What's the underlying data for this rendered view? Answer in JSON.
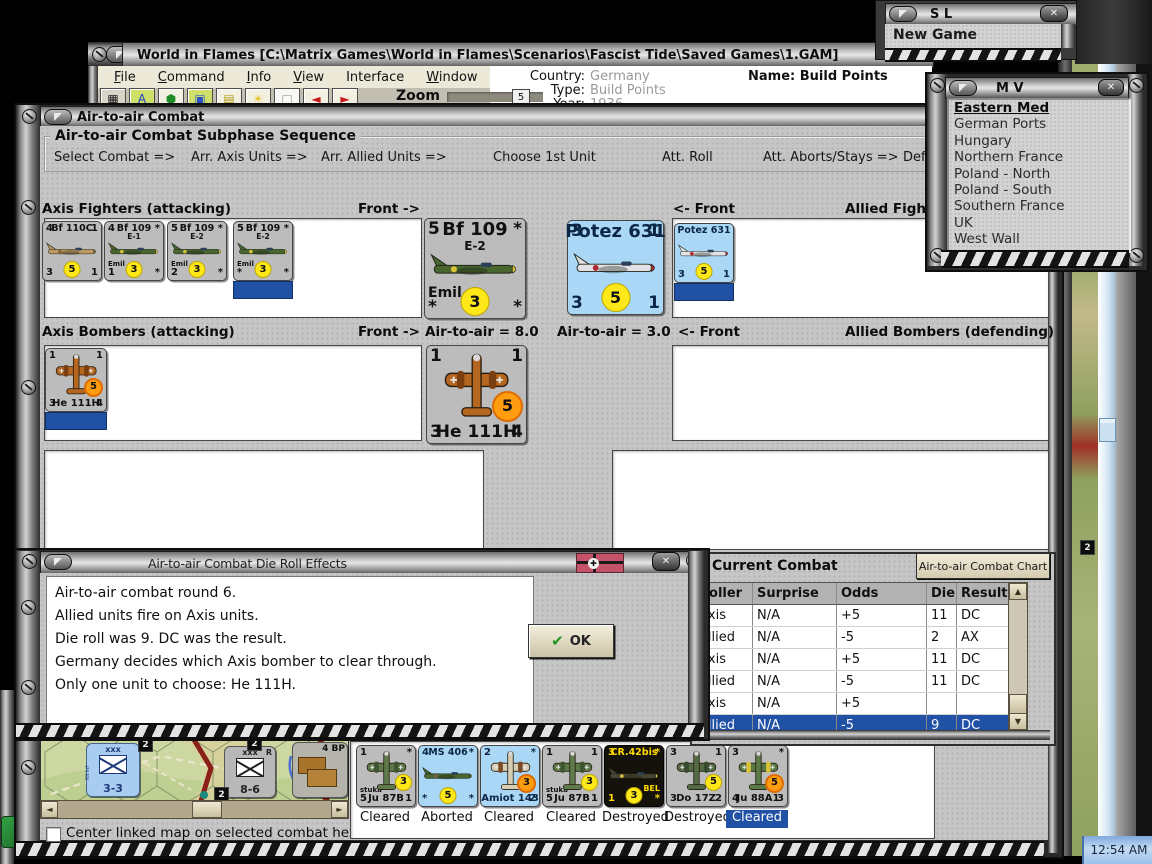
{
  "desktop": {
    "clock": "12:54 AM"
  },
  "main_window": {
    "title": "World in Flames [C:\\Matrix Games\\World in Flames\\Scenarios\\Fascist Tide\\Saved Games\\1.GAM]",
    "menu_items": [
      {
        "label": "File",
        "accel": true
      },
      {
        "label": "Command",
        "accel": true
      },
      {
        "label": "Info",
        "accel": true
      },
      {
        "label": "View",
        "accel": true
      },
      {
        "label": "Interface",
        "accel": false
      },
      {
        "label": "Window",
        "accel": true
      },
      {
        "label": "Debug",
        "accel": false
      },
      {
        "label": "Help",
        "accel": true
      }
    ],
    "toolbar": {
      "zoom_label": "Zoom",
      "zoom_value": "5",
      "icons": [
        {
          "name": "train-icon",
          "glyph": "▦",
          "color": "#161616",
          "bg": "#d8d4c8"
        },
        {
          "name": "letter-a-icon",
          "glyph": "A",
          "color": "#1a3ac8",
          "bg": "#cfe06a"
        },
        {
          "name": "shield-icon",
          "glyph": "⬢",
          "color": "#1d8a24",
          "bg": "#f2f0e0"
        },
        {
          "name": "map-window-icon",
          "glyph": "▣",
          "color": "#2a50c8",
          "bg": "#cfe06a"
        },
        {
          "name": "notes-icon",
          "glyph": "▤",
          "color": "#b09a10",
          "bg": "#f2f0e0"
        },
        {
          "name": "sun-icon",
          "glyph": "☀",
          "color": "#e8c020",
          "bg": "#f2f0e0"
        },
        {
          "name": "blank-icon",
          "glyph": "□",
          "color": "#999999",
          "bg": "#f8f8f4"
        },
        {
          "name": "arrow-left-icon",
          "glyph": "◄",
          "color": "#c81a1a",
          "bg": "#f2f0e0"
        },
        {
          "name": "arrow-right-icon",
          "glyph": "►",
          "color": "#c81a1a",
          "bg": "#f2f0e0"
        }
      ]
    },
    "info": {
      "country_label": "Country:",
      "country_value": "Germany",
      "type_label": "Type:",
      "type_value": "Build Points",
      "year_label": "Year:",
      "year_value": "1936",
      "name_text": "Name: Build Points"
    }
  },
  "sl_window": {
    "title": "S L",
    "item": "New Game"
  },
  "mv_window": {
    "title": "M V",
    "selected_item": "Eastern Med",
    "items": [
      "Eastern Med",
      "German Ports",
      "Hungary",
      "Northern France",
      "Poland - North",
      "Poland - South",
      "Southern France",
      "UK",
      "West Wall"
    ]
  },
  "combat_window": {
    "title": "Air-to-air Combat",
    "sequence": {
      "title": "Air-to-air Combat Subphase Sequence",
      "steps": [
        "Select Combat =>",
        "Arr. Axis Units =>",
        "Arr. Allied Units =>",
        "Choose 1st Unit",
        "Att. Roll",
        "Att. Aborts/Stays =>",
        "Def."
      ]
    },
    "labels": {
      "axis_fighters": "Axis Fighters (attacking)",
      "allied_fighters": "Allied Fighters (defending)",
      "axis_bombers": "Axis Bombers (attacking)",
      "allied_bombers": "Allied Bombers (defending)",
      "front_right": "Front ->",
      "front_left": "<- Front",
      "axis_air": "Air-to-air = 8.0",
      "allied_air": "Air-to-air = 3.0"
    },
    "checkbox_label": "Center linked map on selected combat hex",
    "map": {
      "hex_marker": "2",
      "units": [
        {
          "style": "blue",
          "top": "xxx",
          "side": "XII Inf",
          "value": "3-3"
        },
        {
          "style": "gray",
          "top": "xxx",
          "corner": "R",
          "value": "8-6"
        },
        {
          "style": "bp",
          "label": "4 BP"
        }
      ]
    }
  },
  "units": {
    "axis_fighters": [
      {
        "tl": "4",
        "name": "Bf 110C",
        "tr": "1",
        "bl": "3",
        "badge": "5",
        "br": "1",
        "badge_color": "yellow",
        "bg": "gray",
        "plane": {
          "view": "side",
          "body": "#bf9a60",
          "accent": "#7a623c"
        }
      },
      {
        "tl": "4",
        "name": "Bf 109",
        "sub": "E-1",
        "tr": "*",
        "mid": "Emil",
        "bl": "1",
        "badge": "3",
        "br": "*",
        "badge_color": "yellow",
        "bg": "gray",
        "plane": {
          "view": "side",
          "body": "#49662f",
          "accent": "#d9c23a"
        }
      },
      {
        "tl": "5",
        "name": "Bf 109",
        "sub": "E-2",
        "tr": "*",
        "mid": "Emil",
        "bl": "2",
        "badge": "3",
        "br": "*",
        "badge_color": "yellow",
        "bg": "gray",
        "plane": {
          "view": "side",
          "body": "#49662f",
          "accent": "#d9c23a"
        }
      },
      {
        "tl": "5",
        "name": "Bf 109",
        "sub": "E-2",
        "tr": "*",
        "mid": "Emil",
        "bl": "*",
        "badge": "3",
        "br": "*",
        "badge_color": "yellow",
        "bg": "gray",
        "selected": true,
        "plane": {
          "view": "side",
          "body": "#49662f",
          "accent": "#d9c23a"
        }
      }
    ],
    "front_axis_fighter": {
      "tl": "5",
      "name": "Bf 109",
      "sub": "E-2",
      "tr": "*",
      "mid": "Emil",
      "bl": "*",
      "badge": "3",
      "br": "*",
      "badge_color": "yellow",
      "bg": "gray",
      "plane": {
        "view": "side",
        "body": "#49662f",
        "accent": "#d9c23a"
      }
    },
    "front_allied_fighter": {
      "tl": "3",
      "name": "Potez 631",
      "tr": "1",
      "bl": "3",
      "badge": "5",
      "br": "1",
      "badge_color": "yellow",
      "bg": "blue",
      "plane": {
        "view": "side",
        "body": "#e2e2e6",
        "accent": "#b02830"
      }
    },
    "allied_fighters": [
      {
        "name": "Potez 631",
        "bl": "3",
        "badge": "5",
        "br": "1",
        "badge_color": "yellow",
        "bg": "blue",
        "selected": true,
        "plane": {
          "view": "side",
          "body": "#e2e2e6",
          "accent": "#b02830"
        }
      }
    ],
    "axis_bombers": [
      {
        "tl": "1",
        "tr": "1",
        "bl": "3",
        "bname": "He 111H",
        "br": "4",
        "badge": "5",
        "badge_color": "orange",
        "bg": "gray",
        "selected": true,
        "plane": {
          "view": "top",
          "body": "#b5661f",
          "accent": "#7a3f10"
        }
      }
    ],
    "front_axis_bomber": {
      "tl": "1",
      "tr": "1",
      "bl": "3",
      "bname": "He 111H",
      "br": "4",
      "badge": "5",
      "badge_color": "orange",
      "bg": "gray",
      "plane": {
        "view": "top",
        "body": "#b5661f",
        "accent": "#7a3f10"
      }
    },
    "result_units": [
      {
        "tl": "1",
        "tr": "*",
        "mid": "stuka",
        "bl": "5",
        "bname": "Ju 87B",
        "br": "1",
        "badge": "3",
        "badge_color": "yellow",
        "bg": "gray",
        "status": "Cleared",
        "plane": {
          "view": "top",
          "body": "#5f7a4a",
          "accent": "#3e5530"
        }
      },
      {
        "tl": "4",
        "name": "MS 406",
        "tr": "*",
        "bl": "*",
        "badge": "5",
        "br": "*",
        "badge_color": "yellow",
        "bg": "blue",
        "status": "Aborted",
        "plane": {
          "view": "side",
          "body": "#49662f",
          "accent": "#7a623c"
        }
      },
      {
        "tl": "2",
        "tr": "*",
        "bname": "Amiot 143",
        "br": "2",
        "badge": "3",
        "badge_color": "orange",
        "bg": "blue",
        "status": "Cleared",
        "plane": {
          "view": "top",
          "body": "#d6cdb2",
          "accent": "#7a4a28"
        }
      },
      {
        "tl": "1",
        "tr": "1",
        "mid": "stuka",
        "bl": "5",
        "bname": "Ju 87B",
        "br": "1",
        "badge": "3",
        "badge_color": "yellow",
        "bg": "gray",
        "status": "Cleared",
        "plane": {
          "view": "top",
          "body": "#5f7a4a",
          "accent": "#3e5530"
        }
      },
      {
        "tl": "3",
        "name": "CR.42bis",
        "tr": "*",
        "midr": "BEL",
        "bl": "1",
        "badge": "3",
        "br": "*",
        "badge_color": "yellow",
        "bg": "black",
        "status": "Destroyed",
        "plane": {
          "view": "side",
          "body": "#4a4432",
          "accent": "#d9c23a"
        }
      },
      {
        "tl": "3",
        "tr": "1",
        "bl": "3",
        "bname": "Do 17Z",
        "br": "2",
        "badge": "5",
        "badge_color": "yellow",
        "bg": "gray",
        "status": "Destroyed",
        "plane": {
          "view": "top",
          "body": "#556b45",
          "accent": "#37492c"
        }
      },
      {
        "tl": "3",
        "tr": "*",
        "bl": "4",
        "bname": "Ju 88A1",
        "br": "3",
        "badge": "5",
        "badge_color": "orange",
        "bg": "gray",
        "selected": true,
        "status": "Cleared",
        "plane": {
          "view": "top",
          "body": "#5a7a46",
          "accent": "#d9c23a"
        }
      }
    ]
  },
  "dialog": {
    "title": "Air-to-air Combat Die Roll Effects",
    "lines": [
      "Air-to-air combat round 6.",
      "Allied units fire on Axis units.",
      "Die roll was 9.  DC was the result.",
      "Germany decides which Axis bomber to clear through.",
      "Only one unit to choose: He 111H."
    ],
    "ok_label": "OK"
  },
  "current_combat": {
    "title": "Current Combat",
    "chart_button_label": "Air-to-air Combat Chart",
    "columns": [
      "Roller",
      "Surprise",
      "Odds",
      "Die",
      "Result"
    ],
    "rows": [
      [
        "Axis",
        "N/A",
        "+5",
        "11",
        "DC"
      ],
      [
        "Allied",
        "N/A",
        "-5",
        "2",
        "AX"
      ],
      [
        "Axis",
        "N/A",
        "+5",
        "11",
        "DC"
      ],
      [
        "Allied",
        "N/A",
        "-5",
        "11",
        "DC"
      ],
      [
        "Axis",
        "N/A",
        "+5",
        "",
        ""
      ],
      [
        "Allied",
        "N/A",
        "-5",
        "9",
        "DC"
      ]
    ],
    "selected_row_index": 5
  },
  "colors": {
    "selection_blue": "#2151a5",
    "counter_gray": "#bcbcbc",
    "counter_blue": "#a9d7f5",
    "badge_yellow": "#ffe81a",
    "badge_orange": "#ff9c10"
  }
}
